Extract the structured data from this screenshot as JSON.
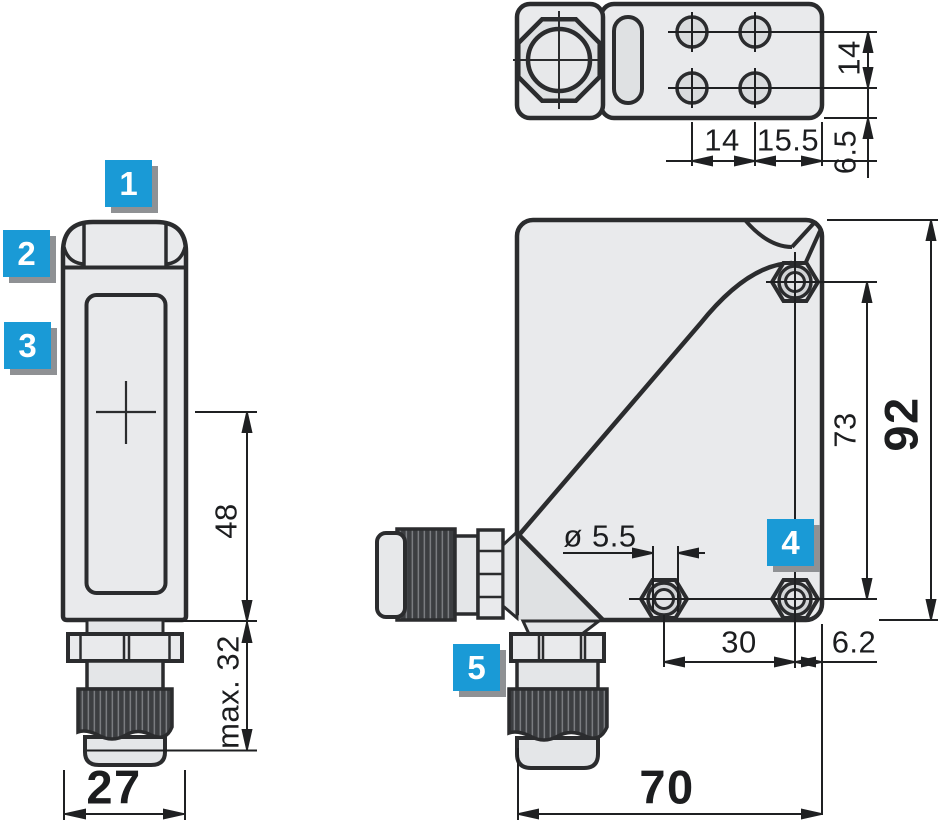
{
  "callouts": {
    "c1": "1",
    "c2": "2",
    "c3": "3",
    "c4": "4",
    "c5": "5"
  },
  "side_view": {
    "width": "27",
    "axis_to_bottom": "48",
    "gland_length": "max. 32"
  },
  "top_view": {
    "hole_pitch_x": "14",
    "edge_offset_x": "15.5",
    "hole_pitch_y": "14",
    "edge_offset_y": "6.5"
  },
  "front_view": {
    "width": "70",
    "height": "92",
    "hole_pitch_y": "73",
    "hole_pitch_x": "30",
    "edge_offset_x": "6.2",
    "hole_diameter": "ø 5.5"
  },
  "colors": {
    "callout_blue": "#1a9ad6",
    "housing_fill": "#e9eaec",
    "shaded_fill": "#dfe1e3",
    "hole_fill": "#d9dbdd",
    "knurl_dark": "#3c3e41",
    "line_color": "#2b2c2e"
  }
}
